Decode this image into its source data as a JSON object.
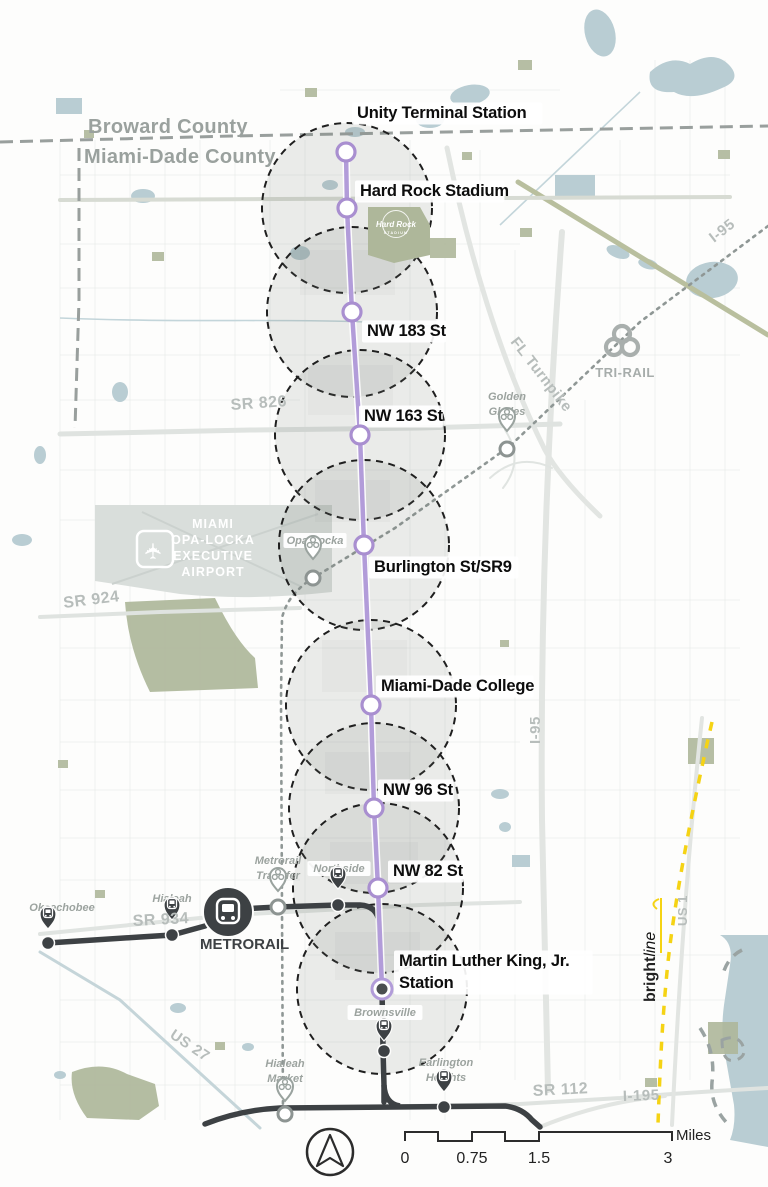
{
  "map": {
    "title": "North Corridor transit map",
    "counties": [
      {
        "text": "Broward County",
        "x": 88,
        "y": 133
      },
      {
        "text": "Miami-Dade County",
        "x": 84,
        "y": 163
      }
    ],
    "corridor_color": "#b29cd9",
    "buffer_radius": 85,
    "stations": [
      {
        "name": "Unity Terminal Station",
        "x": 346,
        "y": 152,
        "buffer": false,
        "terminal": false,
        "label": {
          "x": 357,
          "y": 118,
          "lines": [
            "Unity Terminal Station"
          ]
        }
      },
      {
        "name": "Hard Rock Stadium",
        "x": 347,
        "y": 208,
        "buffer": true,
        "terminal": false,
        "label": {
          "x": 360,
          "y": 196,
          "lines": [
            "Hard Rock Stadium"
          ]
        }
      },
      {
        "name": "NW 183 St",
        "x": 352,
        "y": 312,
        "buffer": true,
        "terminal": false,
        "label": {
          "x": 367,
          "y": 336,
          "lines": [
            "NW 183 St"
          ]
        }
      },
      {
        "name": "NW 163 St",
        "x": 360,
        "y": 435,
        "buffer": true,
        "terminal": false,
        "label": {
          "x": 364,
          "y": 421,
          "lines": [
            "NW 163 St"
          ]
        }
      },
      {
        "name": "Burlington St/SR9",
        "x": 364,
        "y": 545,
        "buffer": true,
        "terminal": false,
        "label": {
          "x": 374,
          "y": 572,
          "lines": [
            "Burlington St/SR9"
          ]
        }
      },
      {
        "name": "Miami-Dade College",
        "x": 371,
        "y": 705,
        "buffer": true,
        "terminal": false,
        "label": {
          "x": 381,
          "y": 691,
          "lines": [
            "Miami-Dade College"
          ]
        }
      },
      {
        "name": "NW 96 St",
        "x": 374,
        "y": 808,
        "buffer": true,
        "terminal": false,
        "label": {
          "x": 383,
          "y": 795,
          "lines": [
            "NW 96 St"
          ]
        }
      },
      {
        "name": "NW 82 St",
        "x": 378,
        "y": 888,
        "buffer": true,
        "terminal": false,
        "label": {
          "x": 393,
          "y": 876,
          "lines": [
            "NW 82 St"
          ]
        }
      },
      {
        "name": "Martin Luther King, Jr. Station",
        "x": 382,
        "y": 989,
        "buffer": true,
        "terminal": true,
        "label": {
          "x": 399,
          "y": 966,
          "lines": [
            "Martin Luther King, Jr.",
            "Station"
          ]
        }
      }
    ],
    "road_labels": [
      {
        "text": "FL Turnpike",
        "x": 510,
        "y": 342,
        "rot": 52,
        "size": 15
      },
      {
        "text": "I-95",
        "x": 714,
        "y": 243,
        "rot": -38,
        "size": 15
      },
      {
        "text": "I-95",
        "x": 540,
        "y": 744,
        "rot": -90,
        "size": 15
      },
      {
        "text": "I-195",
        "x": 623,
        "y": 1101,
        "rot": -2,
        "size": 15
      },
      {
        "text": "SR 826",
        "x": 231,
        "y": 410,
        "rot": -4,
        "size": 16
      },
      {
        "text": "SR 924",
        "x": 64,
        "y": 608,
        "rot": -7,
        "size": 16
      },
      {
        "text": "SR 934",
        "x": 133,
        "y": 926,
        "rot": -3,
        "size": 16
      },
      {
        "text": "SR 112",
        "x": 533,
        "y": 1096,
        "rot": -3,
        "size": 16
      },
      {
        "text": "US 27",
        "x": 169,
        "y": 1037,
        "rot": 34,
        "size": 15
      },
      {
        "text": "US 1",
        "x": 687,
        "y": 926,
        "rot": -90,
        "size": 13
      }
    ],
    "places": [
      {
        "lines": [
          "Golden",
          "Glades"
        ],
        "tx": 507,
        "ty": 400,
        "pin": "trirail",
        "px": 507,
        "py": 431,
        "ring": [
          507,
          449
        ]
      },
      {
        "lines": [
          "Opa-Locka"
        ],
        "tx": 315,
        "ty": 544,
        "pin": "trirail",
        "px": 313,
        "py": 559,
        "ring": [
          313,
          578
        ],
        "box": true
      },
      {
        "lines": [
          "Metrorail",
          "Transfer"
        ],
        "tx": 278,
        "ty": 864,
        "pin": "trirail",
        "px": 278,
        "py": 891,
        "ring": [
          278,
          907
        ]
      },
      {
        "lines": [
          "Hialeah",
          "Market"
        ],
        "tx": 285,
        "ty": 1067,
        "pin": "trirail",
        "px": 285,
        "py": 1101,
        "ring": [
          285,
          1114
        ]
      },
      {
        "lines": [
          "Northside"
        ],
        "tx": 339,
        "ty": 872,
        "pin": "metrorail",
        "px": 338,
        "py": 889,
        "dot": [
          338,
          905
        ],
        "box": true
      },
      {
        "lines": [
          "Okeechobee"
        ],
        "tx": 62,
        "ty": 911,
        "pin": "metrorail",
        "px": 48,
        "py": 929,
        "dot": [
          48,
          943
        ]
      },
      {
        "lines": [
          "Hialeah"
        ],
        "tx": 172,
        "ty": 902,
        "pin": "metrorail",
        "px": 172,
        "py": 920,
        "dot": [
          172,
          935
        ]
      },
      {
        "lines": [
          "Brownsville"
        ],
        "tx": 385,
        "ty": 1016,
        "pin": "metrorail",
        "px": 384,
        "py": 1041,
        "dot": [
          384,
          1051
        ],
        "box": true
      },
      {
        "lines": [
          "Earlington",
          "Heights"
        ],
        "tx": 446,
        "ty": 1066,
        "pin": "metrorail",
        "px": 444,
        "py": 1092,
        "dot": [
          444,
          1107
        ]
      }
    ],
    "metrorail_label": "METRORAIL",
    "trirail_label": "TRI-RAIL",
    "brightline": {
      "part1": "bright",
      "part2": "line"
    },
    "airport": {
      "lines": [
        "MIAMI",
        "OPA-LOCKA",
        "EXECUTIVE",
        "AIRPORT"
      ]
    },
    "hard_rock": {
      "name": "Hard Rock",
      "sub": "STADIUM"
    },
    "scale": {
      "values": [
        "0",
        "0.75",
        "1.5",
        "3"
      ],
      "positions": [
        405,
        472,
        539,
        668
      ],
      "unit": "Miles"
    },
    "colors": {
      "corridor": "#b29cd9",
      "metrorail": "#3d4144",
      "trirail_gray": "#8f9795",
      "brightline_yellow": "#f5d314",
      "water": "#b9cdd3",
      "park": "#aeb79a",
      "airport_gray": "#d9dedb",
      "label_gray": "#b7bdbb",
      "county_gray": "#9aa19e",
      "italic_gray": "#9ca39f",
      "buffer_stroke": "#1f1f1f"
    }
  }
}
